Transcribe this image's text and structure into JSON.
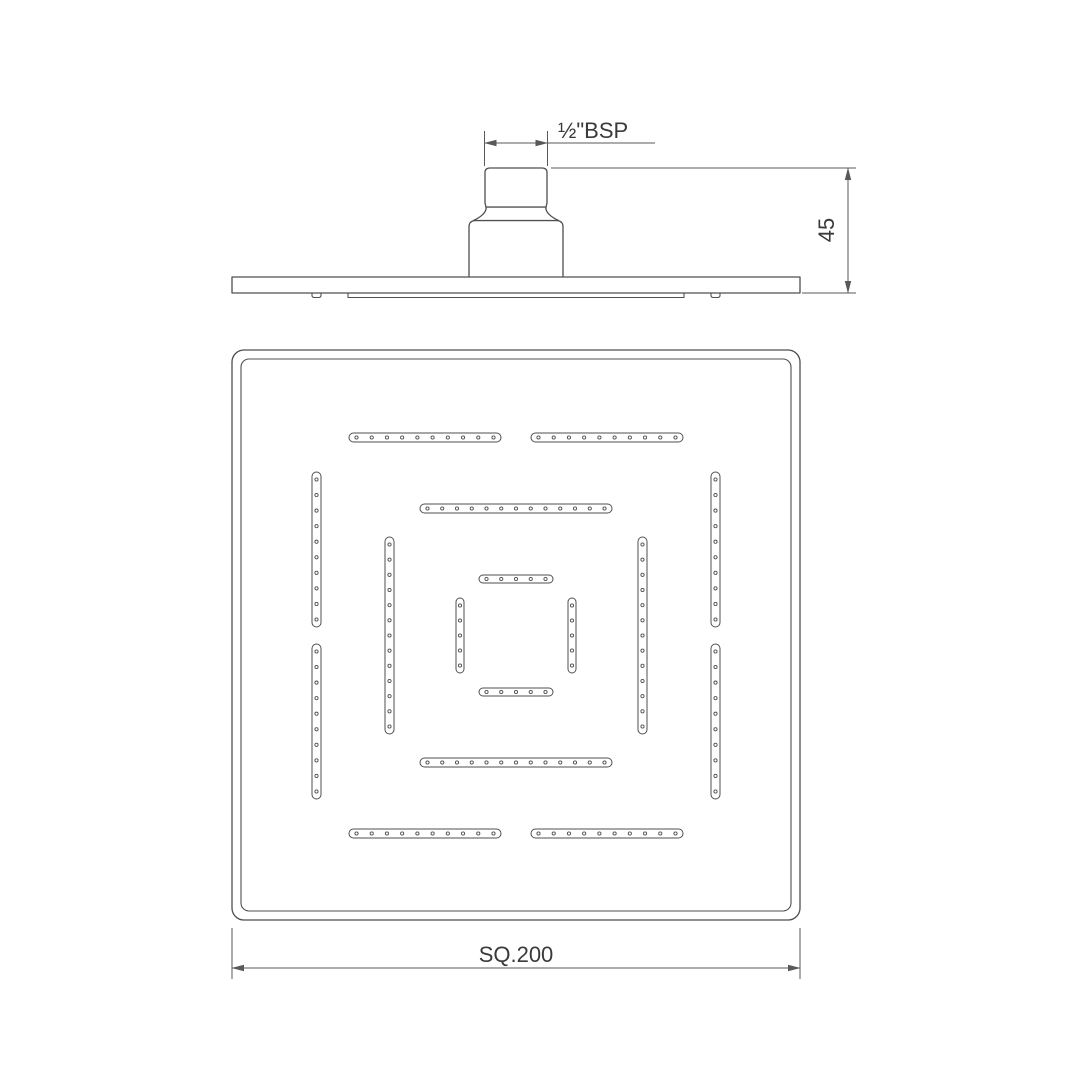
{
  "colors": {
    "background": "#ffffff",
    "line": "#4f4f4f",
    "dimension_line": "#58595b",
    "text": "#3a3a3a"
  },
  "side_view": {
    "labels": {
      "thread_size": "½\"BSP",
      "height_mm": "45"
    }
  },
  "plan_view": {
    "labels": {
      "size": "SQ.200"
    },
    "nozzle_strips": [
      {
        "name": "outer-top-left",
        "orientation": "h",
        "x": 349,
        "y": 433,
        "length": 152,
        "width": 9,
        "dots": 10
      },
      {
        "name": "outer-top-right",
        "orientation": "h",
        "x": 531,
        "y": 433,
        "length": 152,
        "width": 9,
        "dots": 10
      },
      {
        "name": "outer-bottom-left",
        "orientation": "h",
        "x": 349,
        "y": 829,
        "length": 152,
        "width": 9,
        "dots": 10
      },
      {
        "name": "outer-bottom-right",
        "orientation": "h",
        "x": 531,
        "y": 829,
        "length": 152,
        "width": 9,
        "dots": 10
      },
      {
        "name": "outer-left-top",
        "orientation": "v",
        "x": 312,
        "y": 472,
        "length": 155,
        "width": 9,
        "dots": 10
      },
      {
        "name": "outer-left-bottom",
        "orientation": "v",
        "x": 312,
        "y": 644,
        "length": 155,
        "width": 9,
        "dots": 10
      },
      {
        "name": "outer-right-top",
        "orientation": "v",
        "x": 711,
        "y": 472,
        "length": 155,
        "width": 9,
        "dots": 10
      },
      {
        "name": "outer-right-bottom",
        "orientation": "v",
        "x": 711,
        "y": 644,
        "length": 155,
        "width": 9,
        "dots": 10
      },
      {
        "name": "middle-top",
        "orientation": "h",
        "x": 420,
        "y": 504,
        "length": 192,
        "width": 9,
        "dots": 13
      },
      {
        "name": "middle-bottom",
        "orientation": "h",
        "x": 420,
        "y": 758,
        "length": 192,
        "width": 9,
        "dots": 13
      },
      {
        "name": "middle-left",
        "orientation": "v",
        "x": 385,
        "y": 537,
        "length": 197,
        "width": 9,
        "dots": 13
      },
      {
        "name": "middle-right",
        "orientation": "v",
        "x": 638,
        "y": 537,
        "length": 197,
        "width": 9,
        "dots": 13
      },
      {
        "name": "inner-top",
        "orientation": "h",
        "x": 479,
        "y": 575,
        "length": 74,
        "width": 8,
        "dots": 5
      },
      {
        "name": "inner-bottom",
        "orientation": "h",
        "x": 479,
        "y": 688,
        "length": 74,
        "width": 8,
        "dots": 5
      },
      {
        "name": "inner-left",
        "orientation": "v",
        "x": 456,
        "y": 598,
        "length": 75,
        "width": 8,
        "dots": 5
      },
      {
        "name": "inner-right",
        "orientation": "v",
        "x": 568,
        "y": 598,
        "length": 75,
        "width": 8,
        "dots": 5
      }
    ]
  }
}
